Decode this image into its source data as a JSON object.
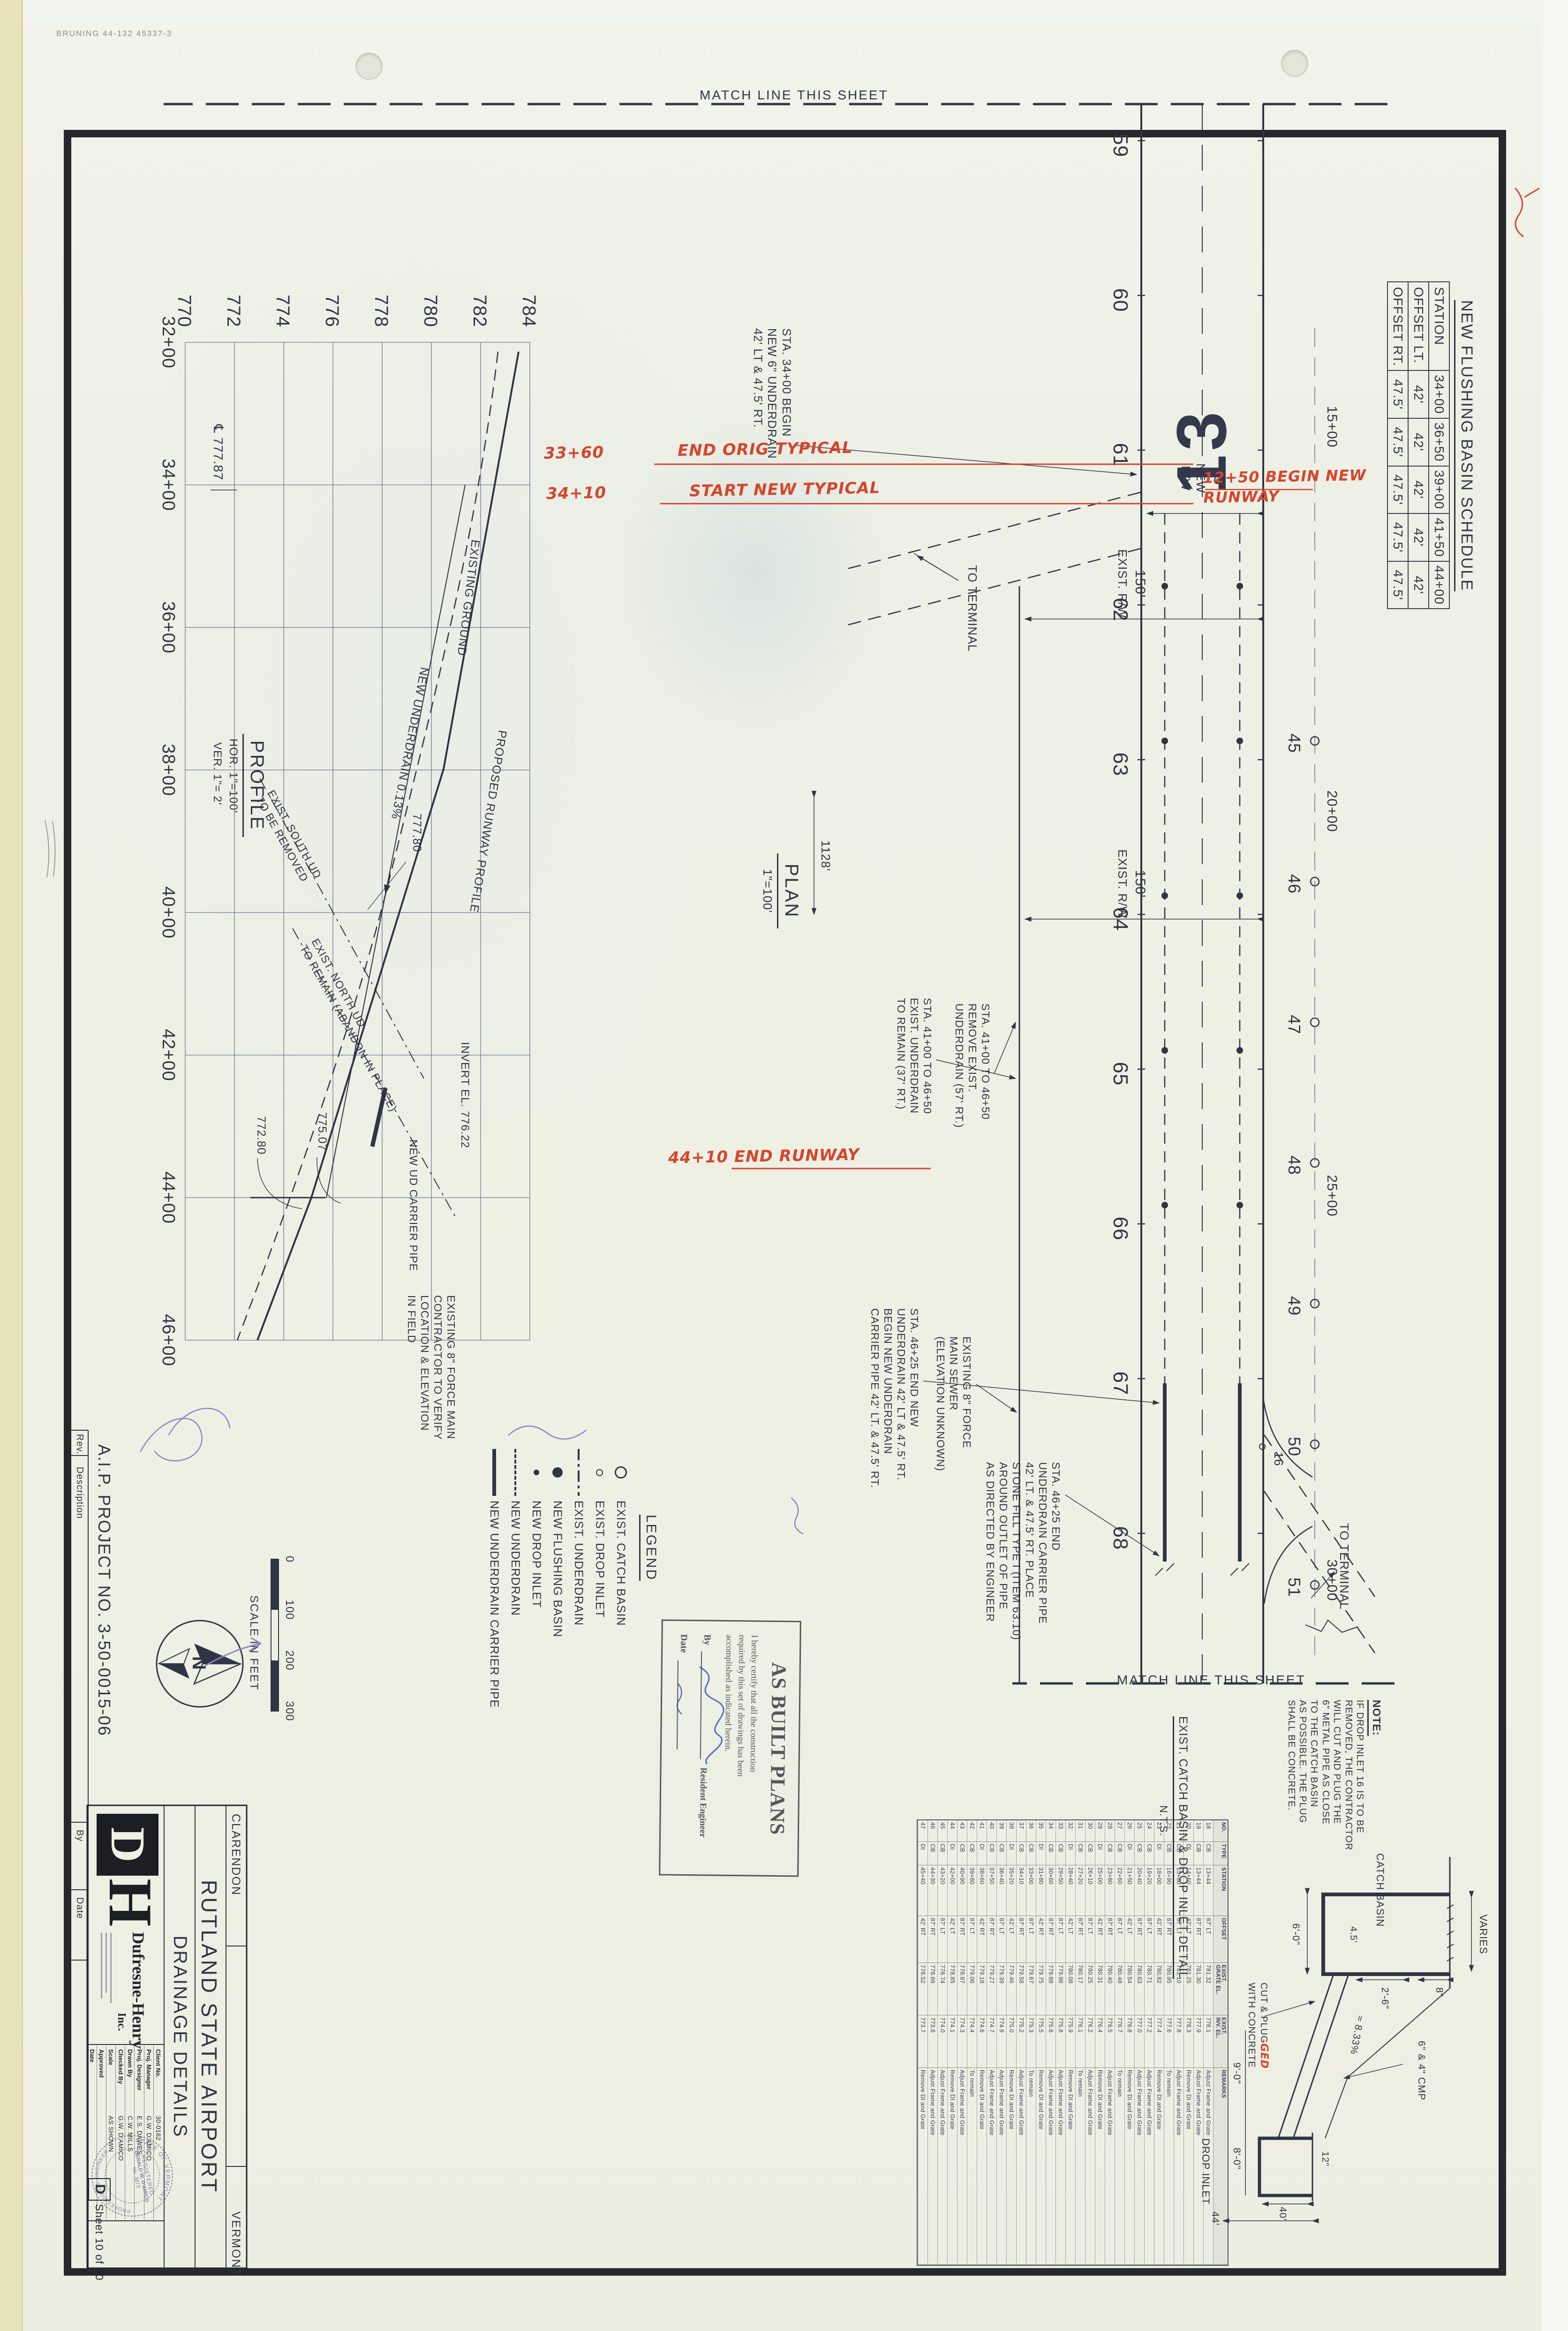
{
  "colors": {
    "ink": "#2f3545",
    "red": "#d5452e",
    "purple": "#8f84c9",
    "paper": "#f0f0e3"
  },
  "meta": {
    "bruning": "BRUNING 44-132 45337-3"
  },
  "match_line_label": "MATCH LINE THIS SHEET",
  "schedule": {
    "title": "NEW FLUSHING BASIN SCHEDULE",
    "row_headers": [
      "STATION",
      "OFFSET LT.",
      "OFFSET RT."
    ],
    "stations": [
      "34+00",
      "36+50",
      "39+00",
      "41+50",
      "44+00"
    ],
    "offset_lt": [
      "42'",
      "42'",
      "42'",
      "42'",
      "42'"
    ],
    "offset_rt": [
      "47.5'",
      "47.5'",
      "47.5'",
      "47.5'",
      "47.5'"
    ]
  },
  "plan": {
    "title": "PLAN",
    "scale": "1\"=100'",
    "runway_number": "13",
    "top_stations": [
      "59",
      "60",
      "61",
      "62",
      "63",
      "64",
      "65",
      "66",
      "67",
      "68"
    ],
    "basin_row": [
      "45",
      "46",
      "47",
      "48",
      "49",
      "50",
      "51"
    ],
    "cl_stations": [
      "15+00",
      "20+00",
      "25+00",
      "30+00"
    ],
    "di_16": "16",
    "dim_new_rw": "75'",
    "lbl_new_rw": "NEW\nR/W",
    "dim_exist_rw": "150'",
    "lbl_exist_rw": "EXIST.  R/W",
    "dim_1128": "1128'",
    "to_terminal": "TO TERMINAL",
    "callout_sta3400": "STA. 34+00 BEGIN\nNEW 6\" UNDERDRAIN\n42' LT & 47.5' RT.",
    "callout_remove": "STA. 41+00 TO 46+50\nREMOVE EXIST.\nUNDERDRAIN (57' RT.)",
    "callout_remain": "STA. 41+00 TO 46+50\nEXIST. UNDERDRAIN\nTO REMAIN (37' RT.)",
    "callout_sta4625_end": "STA. 46+25 END NEW\nUNDERDRAIN 42' LT & 47.5' RT.\nBEGIN NEW UNDERDRAIN\nCARRIER PIPE 42' LT. & 47.5' RT.",
    "callout_sta4625_pipe": "STA. 46+25 END\nUNDERDRAIN CARRIER PIPE\n42' LT. & 47.5' RT. PLACE\nSTONE FILL TYPE I (ITEM 63.10)\nAROUND OUTLET OF PIPE\nAS DIRECTED BY ENGINEER",
    "callout_force_main": "EXISTING 8\" FORCE\nMAIN SEWER\n(ELEVATION UNKNOWN)"
  },
  "red_notes": {
    "end_orig_sta": "33+60",
    "end_orig": "END ORIG TYPICAL",
    "start_new_sta": "34+10",
    "start_new": "START NEW TYPICAL",
    "begin_runway": "12+50 BEGIN NEW\nRUNWAY",
    "end_runway": "44+10  END RUNWAY"
  },
  "profile": {
    "title": "PROFILE",
    "hor": "HOR. 1\"=100'",
    "ver": "VER. 1\"= 2'",
    "elevations": [
      "784",
      "782",
      "780",
      "778",
      "776",
      "774",
      "772",
      "770"
    ],
    "stations": [
      "32+00",
      "34+00",
      "36+00",
      "38+00",
      "40+00",
      "42+00",
      "44+00",
      "46+00"
    ],
    "lbl_proposed": "PROPOSED RUNWAY PROFILE",
    "lbl_existing": "EXISTING GROUND",
    "lbl_underdrain": "NEW UNDERDRAIN  0.13%",
    "lbl_cl_elev": "℄ 777.87",
    "lbl_77780": "777.80",
    "lbl_north_ud": "EXIST. NORTH UD\nTO REMAIN (ABANDON IN PLACE)",
    "lbl_south_ud": "EXIST. SOUTH UD\nTO BE REMOVED",
    "lbl_carrier": "NEW UD CARRIER PIPE",
    "lbl_invert": "INVERT EL. 776.22",
    "lbl_77507": "775.07",
    "lbl_77280": "772.80",
    "lbl_force": "EXISTING 8\" FORCE MAIN\nCONTRACTOR TO VERIFY\nLOCATION & ELEVATION\nIN FIELD"
  },
  "legend": {
    "title": "LEGEND",
    "items": [
      {
        "symbol": "circle-open-lg",
        "label": "EXIST. CATCH BASIN"
      },
      {
        "symbol": "circle-open-sm",
        "label": "EXIST. DROP INLET"
      },
      {
        "symbol": "line-dashdot",
        "label": "EXIST. UNDERDRAIN"
      },
      {
        "symbol": "circle-fill-lg",
        "label": "NEW FLUSHING BASIN"
      },
      {
        "symbol": "circle-fill-sm",
        "label": "NEW DROP INLET"
      },
      {
        "symbol": "line-dash",
        "label": "NEW UNDERDRAIN"
      },
      {
        "symbol": "line-thick",
        "label": "NEW UNDERDRAIN CARRIER PIPE"
      }
    ]
  },
  "scalebar": {
    "ticks": [
      "0",
      "100",
      "200",
      "300"
    ],
    "caption": "SCALE IN FEET"
  },
  "north_label": "N",
  "aip": "A.I.P. PROJECT NO. 3-50-0015-06",
  "revstrip": {
    "rev": "Rev.",
    "description": "Description",
    "by": "By",
    "date": "Date"
  },
  "stamp": {
    "title": "AS BUILT PLANS",
    "body": "I hereby certify that all the construction\nrequired by this set of drawings has been\naccomplished as indicated herein.",
    "by": "By",
    "role": "Resident Engineer",
    "date": "Date"
  },
  "note": {
    "title": "NOTE:",
    "body": "IF DROP INLET 16 IS TO BE\nREMOVED, THE CONTRACTOR\nWILL CUT AND PLUG THE\n6\" METAL PIPE AS CLOSE\nTO THE CATCH BASIN\nAS POSSIBLE.  THE PLUG\nSHALL BE CONCRETE."
  },
  "detail": {
    "title": "EXIST. CATCH BASIN & DROP INLET DETAIL",
    "nts": "N.T.S.",
    "catch_basin": "CATCH BASIN",
    "drop_inlet": "DROP INLET",
    "varies": "VARIES",
    "d8": "8\"",
    "d26": "2'-6\"",
    "d60": "6'-0\"",
    "d45": "4.5'",
    "d90": "9'-0\"",
    "d80": "8'-0\"",
    "d40": "40'",
    "d44": "44'",
    "d12": "12\"",
    "slope": "≈ 8.33%",
    "cmp": "6\" & 4\" CMP",
    "cut1": "CUT & PLUG",
    "cut_red": "GED",
    "cut2": "WITH CONCRETE"
  },
  "table": {
    "columns": [
      "NO.",
      "TYPE",
      "STATION",
      "OFFSET",
      "EXIST.\nGRATE EL.",
      "EXIST.\nINV. EL.",
      "REMARKS"
    ],
    "rows": [
      [
        "18",
        "CB",
        "13+44",
        "87' LT",
        "781.32",
        "778.1",
        "Adjust Frame and Grate"
      ],
      [
        "19",
        "CB",
        "13+44",
        "87' RT",
        "781.30",
        "777.9",
        "Adjust Frame and Grate"
      ],
      [
        "20",
        "DI",
        "14+60",
        "42' LT",
        "781.25",
        "778.3",
        "Remove DI and Grate"
      ],
      [
        "21",
        "CB",
        "15+80",
        "87' LT",
        "781.10",
        "777.8",
        "Adjust Frame and Grate"
      ],
      [
        "22",
        "CB",
        "16+90",
        "87' RT",
        "780.95",
        "777.6",
        "To remain"
      ],
      [
        "23",
        "DI",
        "18+00",
        "42' RT",
        "780.82",
        "777.4",
        "Remove DI and Grate"
      ],
      [
        "24",
        "CB",
        "19+20",
        "87' LT",
        "780.71",
        "777.2",
        "Adjust Frame and Grate"
      ],
      [
        "25",
        "CB",
        "20+40",
        "87' RT",
        "780.63",
        "777.0",
        "Adjust Frame and Grate"
      ],
      [
        "26",
        "DI",
        "21+50",
        "42' LT",
        "780.54",
        "776.8",
        "Remove DI and Grate"
      ],
      [
        "27",
        "CB",
        "22+60",
        "87' LT",
        "780.48",
        "776.7",
        "To remain"
      ],
      [
        "28",
        "CB",
        "23+80",
        "87' RT",
        "780.40",
        "776.5",
        "Adjust Frame and Grate"
      ],
      [
        "29",
        "DI",
        "25+00",
        "42' RT",
        "780.31",
        "776.4",
        "Remove DI and Grate"
      ],
      [
        "30",
        "CB",
        "26+10",
        "87' LT",
        "780.25",
        "776.2",
        "Adjust Frame and Grate"
      ],
      [
        "31",
        "CB",
        "27+20",
        "87' RT",
        "780.17",
        "776.1",
        "To remain"
      ],
      [
        "32",
        "DI",
        "28+40",
        "42' LT",
        "780.08",
        "775.9",
        "Remove DI and Grate"
      ],
      [
        "33",
        "CB",
        "29+50",
        "87' LT",
        "779.96",
        "775.8",
        "Adjust Frame and Grate"
      ],
      [
        "34",
        "CB",
        "30+60",
        "87' RT",
        "779.88",
        "775.6",
        "Adjust Frame and Grate"
      ],
      [
        "35",
        "DI",
        "31+80",
        "42' RT",
        "779.75",
        "775.5",
        "Remove DI and Grate"
      ],
      [
        "36",
        "CB",
        "33+00",
        "87' LT",
        "779.67",
        "775.3",
        "To remain"
      ],
      [
        "37",
        "CB",
        "34+10",
        "87' RT",
        "779.58",
        "775.2",
        "Adjust Frame and Grate"
      ],
      [
        "38",
        "DI",
        "35+20",
        "42' LT",
        "779.46",
        "775.0",
        "Remove DI and Grate"
      ],
      [
        "39",
        "CB",
        "36+40",
        "87' LT",
        "779.39",
        "774.9",
        "Adjust Frame and Grate"
      ],
      [
        "40",
        "CB",
        "37+50",
        "87' RT",
        "779.27",
        "774.7",
        "Adjust Frame and Grate"
      ],
      [
        "41",
        "DI",
        "38+60",
        "42' RT",
        "779.18",
        "774.6",
        "Remove DI and Grate"
      ],
      [
        "42",
        "CB",
        "39+80",
        "87' LT",
        "779.06",
        "774.4",
        "To remain"
      ],
      [
        "43",
        "CB",
        "40+90",
        "87' RT",
        "778.97",
        "774.3",
        "Adjust Frame and Grate"
      ],
      [
        "44",
        "DI",
        "42+00",
        "42' LT",
        "778.85",
        "774.1",
        "Remove DI and Grate"
      ],
      [
        "45",
        "CB",
        "43+20",
        "87' LT",
        "778.74",
        "774.0",
        "Adjust Frame and Grate"
      ],
      [
        "46",
        "CB",
        "44+30",
        "87' RT",
        "778.66",
        "773.8",
        "Adjust Frame and Grate"
      ],
      [
        "47",
        "DI",
        "45+40",
        "42' RT",
        "778.52",
        "773.7",
        "Remove DI and Grate"
      ]
    ]
  },
  "titleblock": {
    "town": "CLARENDON",
    "state": "VERMONT",
    "project": "RUTLAND STATE AIRPORT",
    "sheet_title": "DRAINAGE DETAILS",
    "logo_d": "D",
    "logo_h": "H",
    "company": "Dufresne-Henry",
    "company_suffix": "Inc.",
    "fields": [
      [
        "Client No.",
        "30-0162"
      ],
      [
        "Proj. Manager",
        "G.W. D'AMICO"
      ],
      [
        "Proj. Designer",
        "E.S. DAWES"
      ],
      [
        "Drawn By",
        "C.W. MILLS"
      ],
      [
        "Checked By",
        "G.W. D'AMICO"
      ],
      [
        "Scale",
        "AS SHOWN"
      ],
      [
        "Approved",
        ""
      ],
      [
        "Date",
        ""
      ]
    ],
    "sheet": "Sheet 10 of 30",
    "rev_letter": "D",
    "seal_top": "STATE OF VERMONT",
    "seal_bottom": "PROFESSIONAL ENGINEER",
    "seal_mid": "REGISTERED",
    "seal_name": "GERALD W. D'AMICO",
    "seal_no": "No. 3873"
  }
}
